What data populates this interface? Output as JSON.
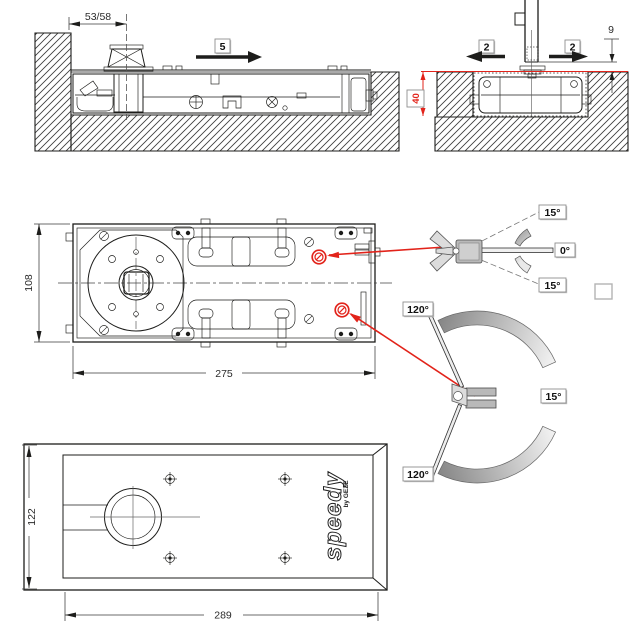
{
  "meta": {
    "background": "#ffffff",
    "line_color": "#1d1d1b",
    "accent_red": "#e2231a",
    "gray_fill": "#b9b9b9"
  },
  "side_section": {
    "spindle_offset_dim": "53/58",
    "direction_label": "5"
  },
  "front_section": {
    "arrow_left_label": "2",
    "arrow_right_label": "2",
    "floor_gap_dim": "9",
    "box_depth_dim": "40"
  },
  "plan_view": {
    "body_width_dim": "108",
    "body_length_dim": "275"
  },
  "swing_diagram": {
    "closed_label": "0°",
    "hold_open_top": "15°",
    "hold_open_bottom": "15°",
    "max_open_top": "120°",
    "max_open_bottom": "120°",
    "hold_open_right": "15°"
  },
  "cover_plate": {
    "width_dim": "122",
    "length_dim": "289",
    "brand": "speedy",
    "brand_sub": "by GEZE"
  }
}
